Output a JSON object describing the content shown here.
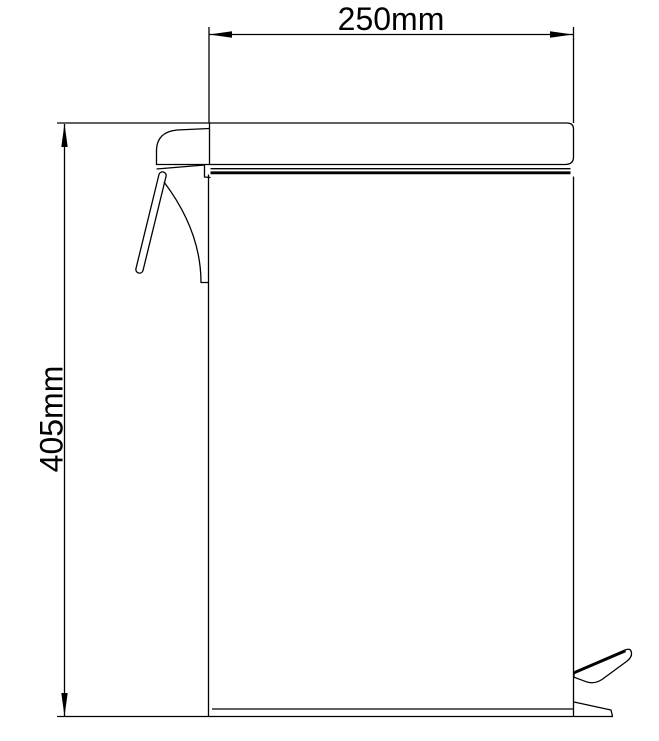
{
  "drawing": {
    "kind": "technical-dimension-diagram",
    "subject": "pedal waste bin side elevation",
    "width_dimension": {
      "label": "250mm",
      "value_mm": 250
    },
    "height_dimension": {
      "label": "405mm",
      "value_mm": 405
    },
    "colors": {
      "line": "#000000",
      "background": "#ffffff"
    }
  }
}
